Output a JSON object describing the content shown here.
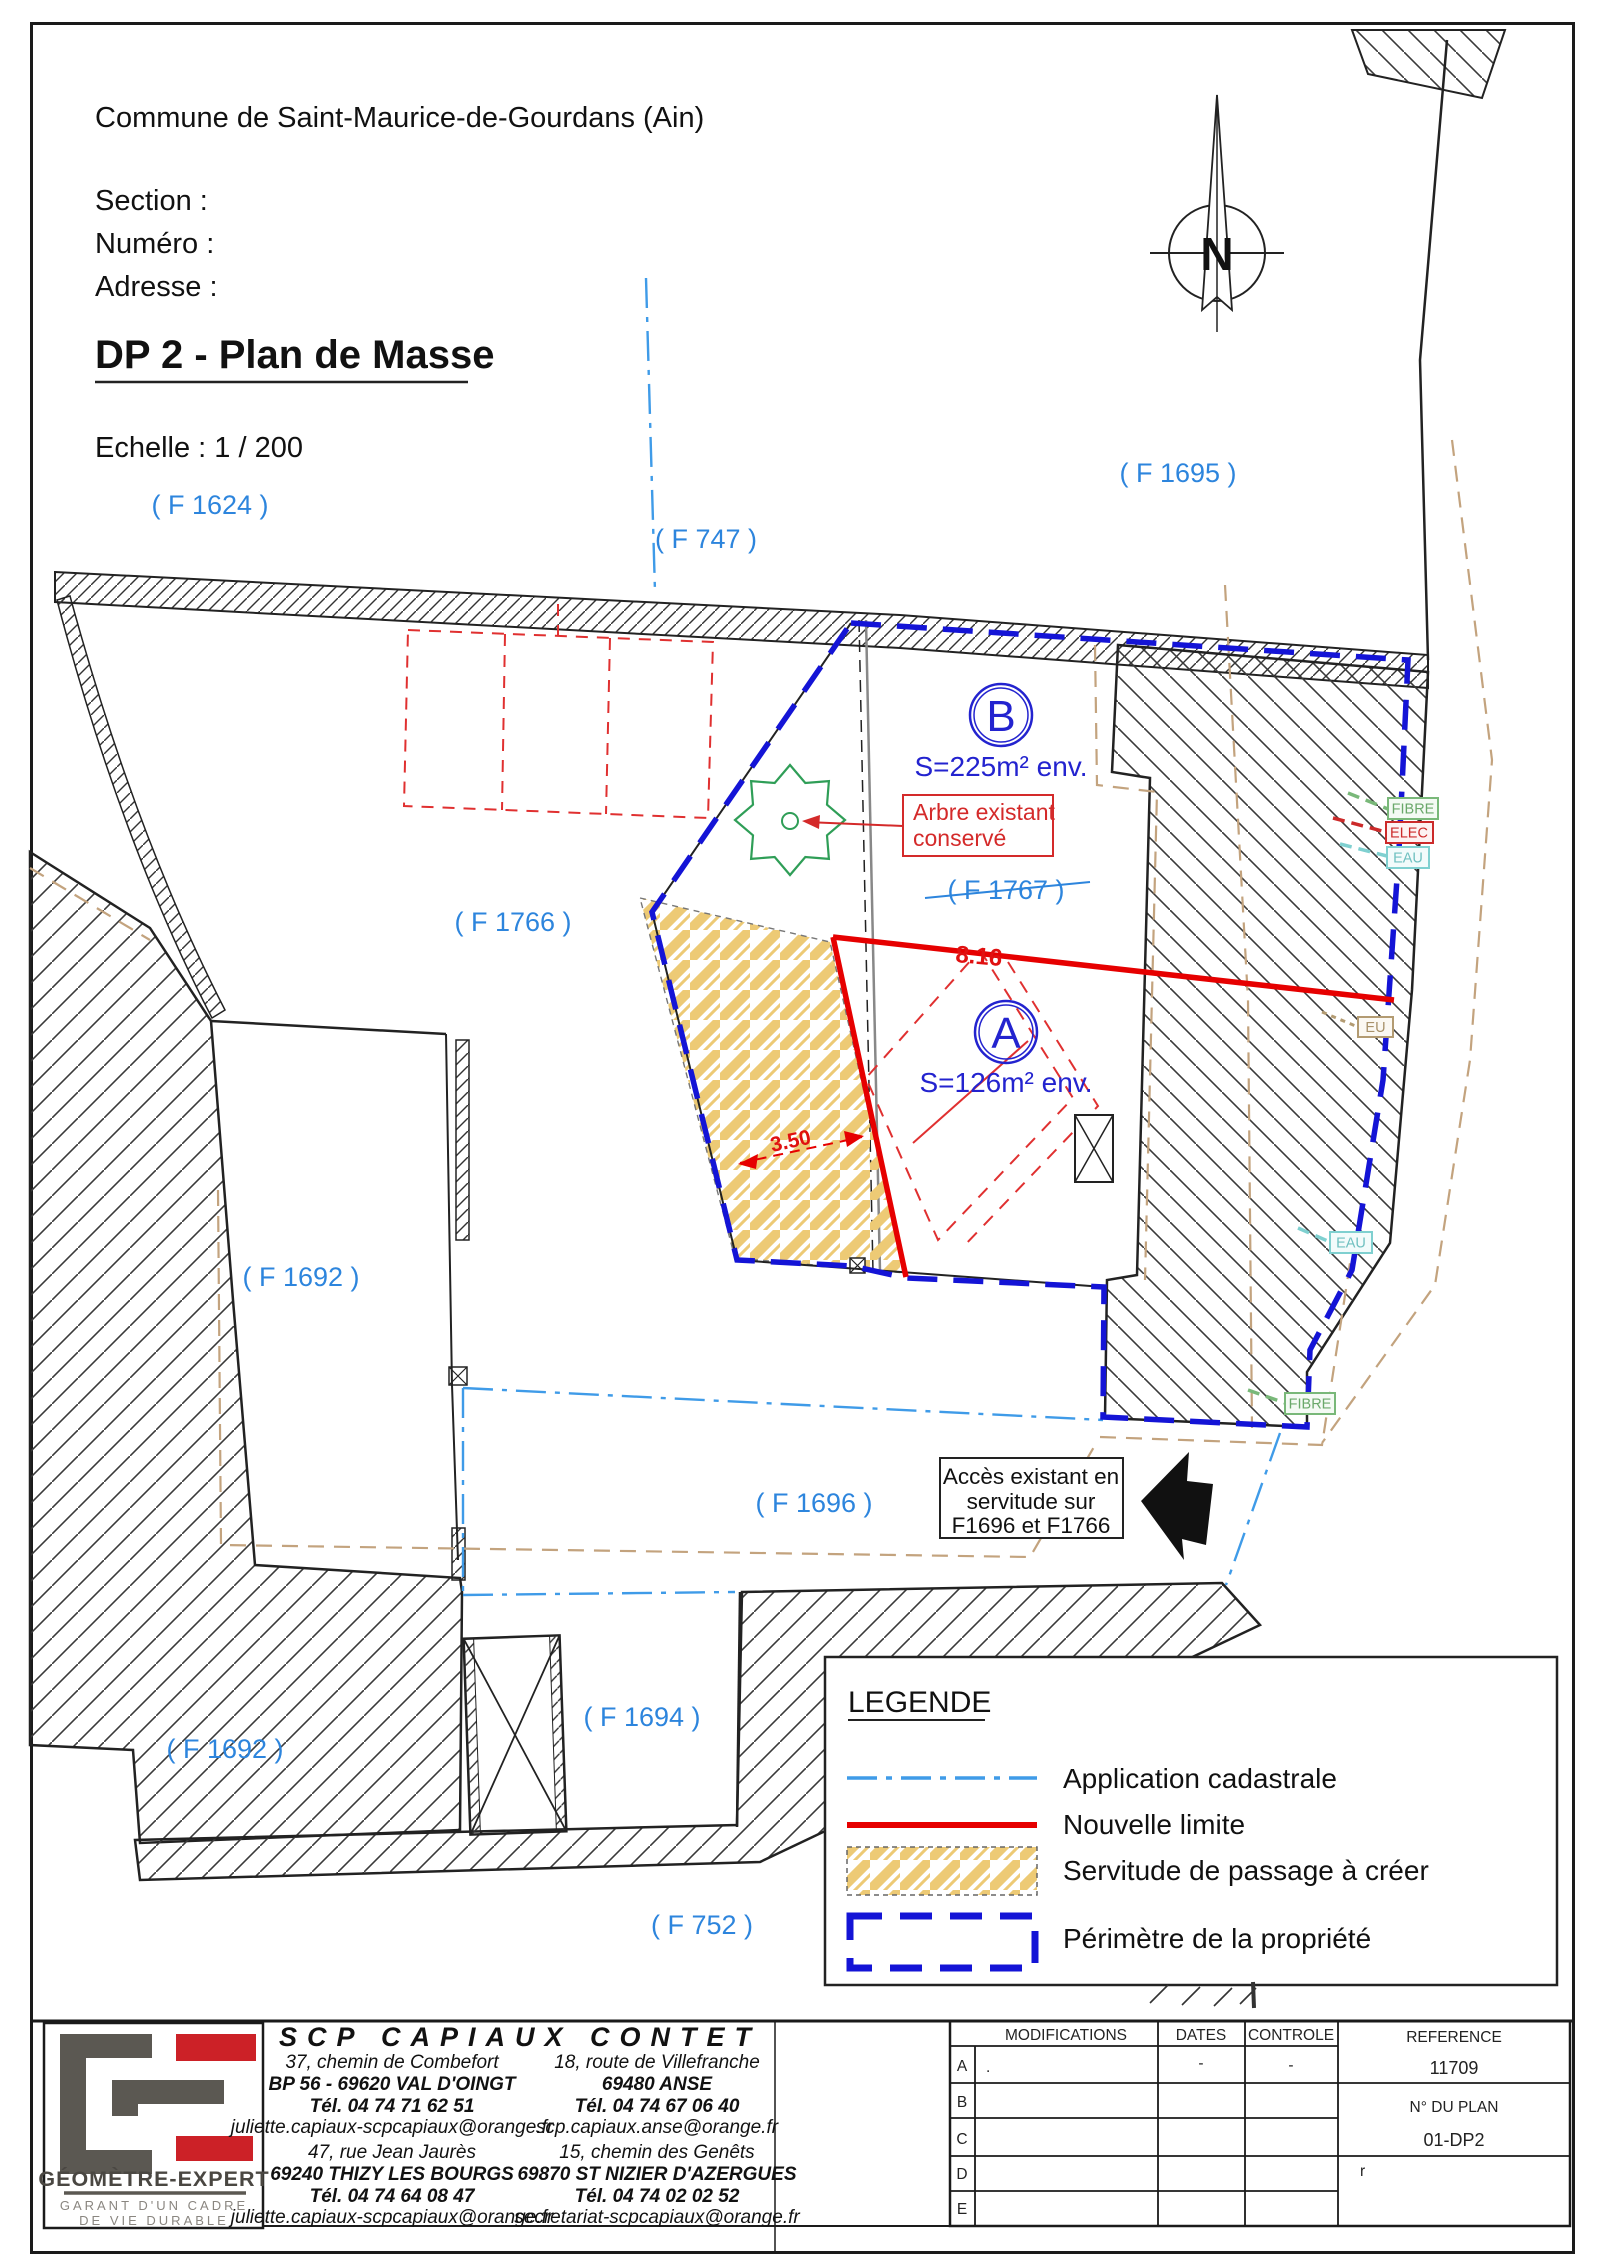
{
  "page": {
    "commune": "Commune de Saint-Maurice-de-Gourdans (Ain)",
    "section_label": "Section :",
    "numero_label": "Numéro :",
    "adresse_label": "Adresse :",
    "section_value": "",
    "numero_value": "",
    "adresse_value": "",
    "title": "DP 2 - Plan de Masse",
    "scale": "Echelle  : 1 / 200"
  },
  "compass": {
    "north": "N"
  },
  "map": {
    "parcels": [
      {
        "id": "F1624",
        "label": "( F 1624 )"
      },
      {
        "id": "F747",
        "label": "( F 747 )"
      },
      {
        "id": "F1695",
        "label": "( F 1695 )"
      },
      {
        "id": "F1766",
        "label": "( F 1766 )"
      },
      {
        "id": "F1767",
        "label": "( F 1767 )"
      },
      {
        "id": "F1692-upper",
        "label": "( F 1692 )"
      },
      {
        "id": "F1696",
        "label": "( F 1696 )"
      },
      {
        "id": "F1692-lower",
        "label": "( F 1692 )"
      },
      {
        "id": "F1694",
        "label": "( F 1694 )"
      },
      {
        "id": "F752",
        "label": "( F 752 )"
      }
    ],
    "zones": [
      {
        "letter": "B",
        "area": "S=225m² env."
      },
      {
        "letter": "A",
        "area": "S=126m² env."
      }
    ],
    "tree_note": {
      "line1": "Arbre existant",
      "line2": "conservé"
    },
    "dimensions": {
      "new_limit_length": "8.16",
      "servitude_width": "3.50"
    },
    "access_note": {
      "line1": "Accès existant en",
      "line2": "servitude sur",
      "line3": "F1696 et F1766"
    },
    "utilities": {
      "fibre_top": "FIBRE",
      "elec": "ELEC",
      "eau_top": "EAU",
      "eu": "EU",
      "eau_bottom": "EAU",
      "fibre_bottom": "FIBRE"
    }
  },
  "legend": {
    "title": "LEGENDE",
    "items": [
      {
        "label": "Application cadastrale",
        "symbol": "blue-dash-dot-line"
      },
      {
        "label": "Nouvelle limite",
        "symbol": "red-solid-line"
      },
      {
        "label": "Servitude de passage à créer",
        "symbol": "yellow-hatch-area"
      },
      {
        "label": "Périmètre de la propriété",
        "symbol": "blue-dashed-rect"
      }
    ]
  },
  "footer": {
    "company": "SCP CAPIAUX CONTET",
    "logo": {
      "brand": "GÉOMÈTRE-EXPERT",
      "tagline1": "GARANT D'UN CADRE",
      "tagline2": "DE VIE DURABLE"
    },
    "offices": [
      {
        "street": "37, chemin de Combefort",
        "city": "BP 56 - 69620 VAL D'OINGT",
        "tel": "Tél. 04 74 71 62 51",
        "email": "juliette.capiaux-scpcapiaux@orange.fr"
      },
      {
        "street": "18, route de Villefranche",
        "city": "69480 ANSE",
        "tel": "Tél. 04 74 67 06 40",
        "email": "scp.capiaux.anse@orange.fr"
      },
      {
        "street": "47, rue Jean Jaurès",
        "city": "69240 THIZY LES BOURGS",
        "tel": "Tél. 04 74 64 08 47",
        "email": "juliette.capiaux-scpcapiaux@orange.fr"
      },
      {
        "street": "15, chemin des Genêts",
        "city": "69870 ST NIZIER D'AZERGUES",
        "tel": "Tél. 04 74 02 02 52",
        "email": "secretariat-scpcapiaux@orange.fr"
      }
    ],
    "table": {
      "headers": {
        "modifications": "MODIFICATIONS",
        "dates": "DATES",
        "controle": "CONTROLE",
        "reference": "REFERENCE"
      },
      "reference_value": "11709",
      "plan_label": "N° DU PLAN",
      "plan_value": "01-DP2",
      "row_letters": [
        "A",
        "B",
        "C",
        "D",
        "E"
      ],
      "row_a_marks": {
        "modifications": ".",
        "dates": "-",
        "controle": "-"
      },
      "stray_mark": "r"
    }
  },
  "colors": {
    "parcel_label_blue": "#2d85dd",
    "zone_blue": "#2323cf",
    "perimeter_blue": "#1414d6",
    "cadastral_blue": "#3f9be8",
    "new_limit_red": "#e60000",
    "servitude_yellow": "#edca75",
    "tan_dash": "#c3a37e",
    "tree_green": "#2f9e57",
    "fibre_green": "#79b879",
    "eau_cyan": "#7fd0d0",
    "eu_tan": "#b39b72",
    "elec_red": "#cc2a2a"
  }
}
